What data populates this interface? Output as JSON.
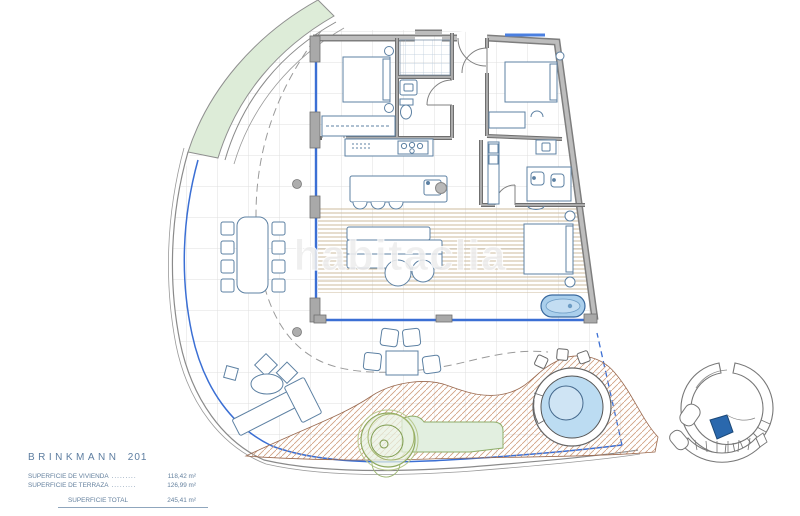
{
  "title": {
    "name": "BRINKMANN",
    "unit": "201"
  },
  "surface_table": {
    "rows": [
      {
        "label": "SUPERFICIE DE VIVIENDA",
        "leader": ".........",
        "value": "118,42 m²"
      },
      {
        "label": "SUPERFICIE DE TERRAZA",
        "leader": ".........",
        "value": "126,99 m²"
      }
    ],
    "total": {
      "label": "SUPERFICIE TOTAL",
      "value": "245,41 m²"
    }
  },
  "watermark": "habitaclia",
  "colors": {
    "boundary_blue": "#3b6fd4",
    "unit_highlight": "#2a68ad",
    "planting_green": "#ddecd8",
    "water_blue": "#bcdcf2",
    "deck_tan": "#cdbb9e",
    "hatch_terracotta": "#cf9e80"
  }
}
